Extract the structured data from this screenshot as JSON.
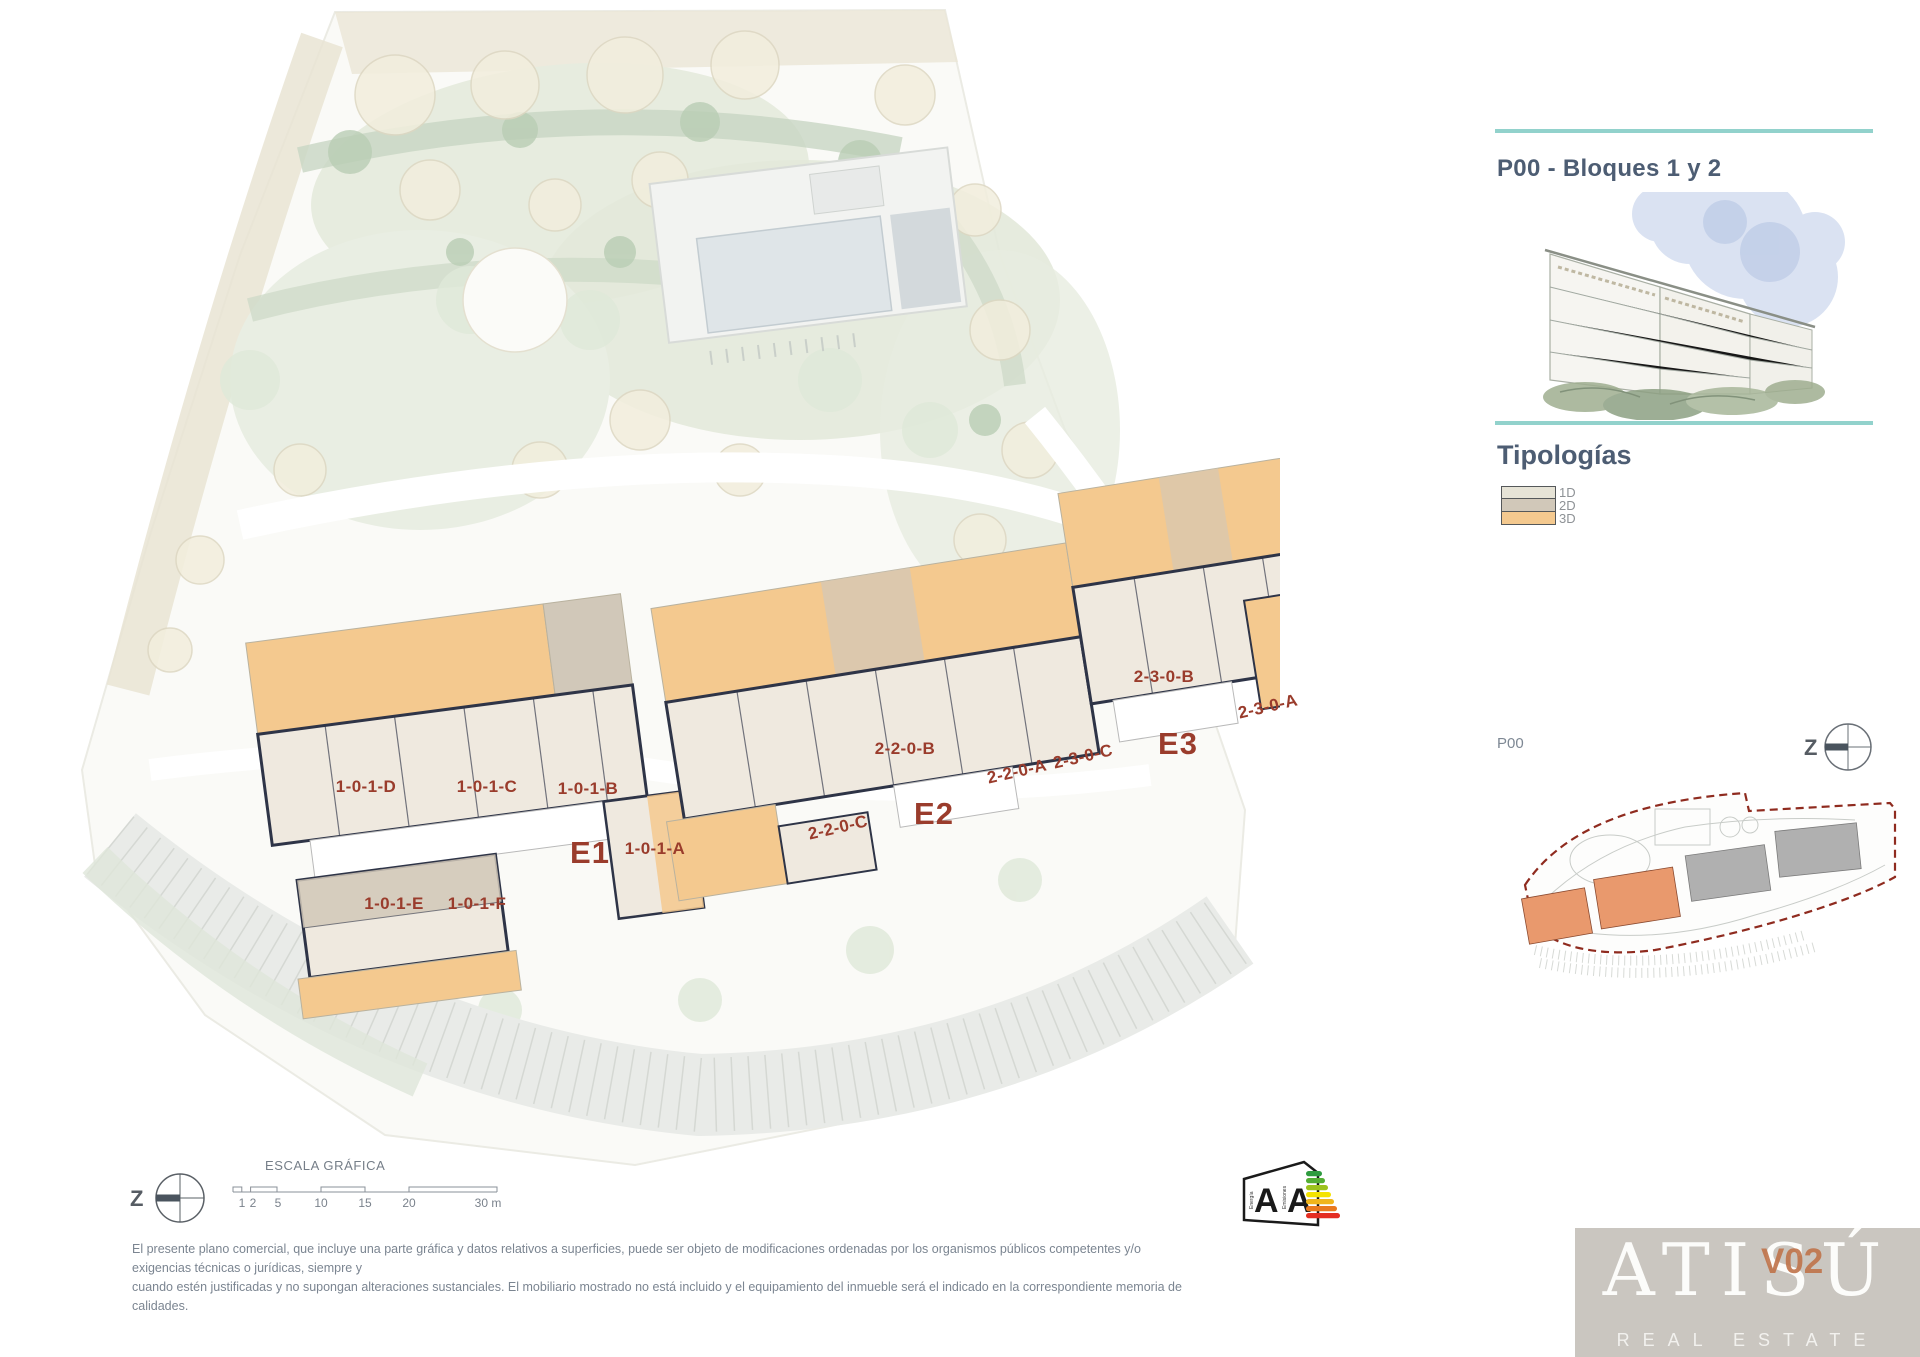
{
  "sidebar": {
    "title": "P00 - Bloques 1 y 2",
    "tipologias_heading": "Tipologías",
    "legend": [
      {
        "label": "1D",
        "color": "#e6e3d6"
      },
      {
        "label": "2D",
        "color": "#d1c8b9"
      },
      {
        "label": "3D",
        "color": "#f4c98f"
      }
    ],
    "minimap_label": "P00",
    "minimap_compass_letter": "Z"
  },
  "plan": {
    "unit_labels": [
      {
        "text": "1-0-1-D"
      },
      {
        "text": "1-0-1-C"
      },
      {
        "text": "1-0-1-B"
      },
      {
        "text": "1-0-1-A"
      },
      {
        "text": "1-0-1-E"
      },
      {
        "text": "1-0-1-F"
      },
      {
        "text": "2-2-0-C"
      },
      {
        "text": "2-2-0-B"
      },
      {
        "text": "2-2-0-A"
      },
      {
        "text": "2-3-0-C"
      },
      {
        "text": "2-3-0-B"
      },
      {
        "text": "2-3-0-A"
      }
    ],
    "entrance_labels": [
      {
        "text": "E1"
      },
      {
        "text": "E2"
      },
      {
        "text": "E3"
      }
    ],
    "colors": {
      "typology_1d": "#e6e3d6",
      "typology_2d": "#d1c8b9",
      "typology_3d": "#f4c98f",
      "walls": "#2e3447",
      "label_red": "#9a3c2c",
      "boundary_red": "#8f2b1f",
      "teal_rule": "#92d2cc"
    }
  },
  "scale_bar": {
    "title": "ESCALA GRÁFICA",
    "tick_labels": [
      "1",
      "2",
      "5",
      "10",
      "15",
      "20",
      "30 m"
    ]
  },
  "compass": {
    "letter": "Z"
  },
  "energy_label": {
    "left_scale": "Energía",
    "right_scale": "Emisiones",
    "left_rating": "A",
    "right_rating": "A"
  },
  "disclaimer": {
    "line1": "El presente plano comercial, que incluye una parte gráfica y datos relativos a superficies, puede ser objeto de modificaciones ordenadas por los organismos públicos competentes y/o exigencias técnicas o jurídicas, siempre y",
    "line2": "cuando estén justificadas y no supongan alteraciones sustanciales. El mobiliario mostrado no está incluido y el equipamiento del inmueble será el indicado en la correspondiente memoria de calidades."
  },
  "logo": {
    "brand": "ATISÚ",
    "tagline": "REAL ESTATE",
    "version": "V02"
  }
}
